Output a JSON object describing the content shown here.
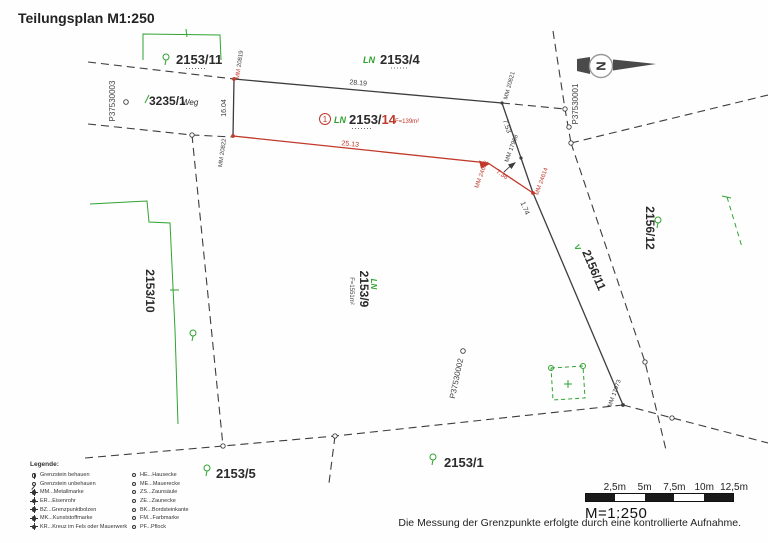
{
  "title": "Teilungsplan M1:250",
  "north": {
    "label": "N"
  },
  "parcels": {
    "p2153_11": {
      "label": "2153/11"
    },
    "p2153_4": {
      "prefix": "LN",
      "label": "2153/4"
    },
    "p3235_1": {
      "label": "3235/1",
      "suffix": "Weg"
    },
    "p2153_14": {
      "index": "1",
      "prefix": "LN",
      "stem": "2153/",
      "new_part": "14",
      "area": "F=139m²"
    },
    "p2153_10": {
      "label": "2153/10"
    },
    "p2153_9": {
      "prefix": "LN",
      "label": "2153/9",
      "area": "F=1551m²"
    },
    "p2153_5": {
      "label": "2153/5"
    },
    "p2153_1": {
      "label": "2153/1"
    },
    "p2156_12": {
      "label": "2156/12"
    },
    "p2156_11": {
      "label": "2156/11",
      "marker": "V"
    }
  },
  "survey_points": {
    "p37530003": "P37530003",
    "p37530001": "P37530001",
    "p37530002": "P37530002",
    "mm_20819": {
      "type": "MM",
      "number": "20819"
    },
    "mm_20821": {
      "type": "MM",
      "number": "20821"
    },
    "mm_20822": {
      "type": "MM",
      "number": "20822"
    },
    "mm_17968": {
      "type": "MM",
      "number": "17968"
    },
    "mm_17973": {
      "type": "MM",
      "number": "17973"
    },
    "mm_24612": {
      "type": "MM",
      "number": "24612"
    },
    "mm_24614": {
      "type": "MM",
      "number": "24614"
    }
  },
  "measurements": {
    "top_edge": "28.19",
    "left_edge": "16.04",
    "new_boundary_long": "25.13",
    "right_upper": "7.53",
    "new_boundary_short": "7.36",
    "right_lower": "1.74"
  },
  "legend": {
    "heading": "Legende:",
    "left": [
      {
        "label": "Grenzstein behauen"
      },
      {
        "label": "Grenzstein unbehauen"
      },
      {
        "label": "MM...Metallmarke"
      },
      {
        "label": "ER...Eisenrohr"
      },
      {
        "label": "BZ...Grenzpunktbolzen"
      },
      {
        "label": "MK...Kunststoffmarke"
      },
      {
        "label": "KR...Kreuz im Fels oder Mauerwerk"
      }
    ],
    "right": [
      {
        "label": "HE...Hausecke"
      },
      {
        "label": "ME...Mauerecke"
      },
      {
        "label": "ZS...Zaunsäule"
      },
      {
        "label": "ZE...Zaunecke"
      },
      {
        "label": "BK...Bordsteinkante"
      },
      {
        "label": "FM...Farbmarke"
      },
      {
        "label": "PF...Pflock"
      }
    ]
  },
  "scale_bar": {
    "tick_labels": [
      "2,5m",
      "5m",
      "7,5m",
      "10m",
      "12,5m"
    ],
    "scale_text": "M=1:250"
  },
  "footnote": "Die Messung der Grenzpunkte erfolgte durch eine kontrollierte Aufnahme.",
  "colors": {
    "line": "#3d3d3d",
    "new_red": "#c0392b",
    "green": "#2fa32f"
  }
}
